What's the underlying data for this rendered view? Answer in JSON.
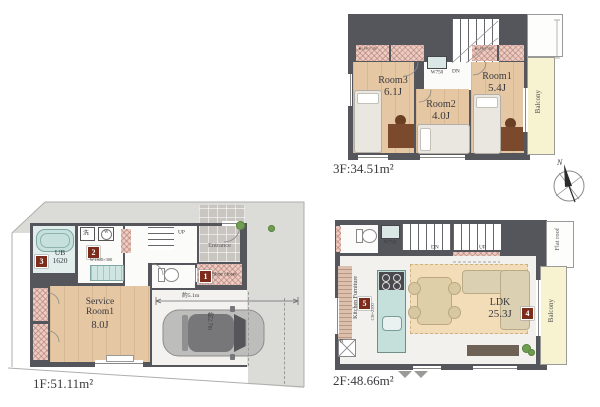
{
  "compass": {
    "label": "N"
  },
  "badges": {
    "b1": "1",
    "b2": "2",
    "b3": "3",
    "b4": "4",
    "b5": "5"
  },
  "floor3": {
    "area_label": "3F:34.51m²",
    "rooms": [
      {
        "name": "Room3",
        "size": "6.1J"
      },
      {
        "name": "Room2",
        "size": "4.0J"
      },
      {
        "name": "Room1",
        "size": "5.4J"
      }
    ],
    "balcony_label": "Balcony",
    "closet_label": "W750",
    "stair_down_label": "DN",
    "closet_note_left": "▲CH=1.3m",
    "closet_note_right": "▲CH=1.3m"
  },
  "floor2": {
    "area_label": "2F:48.66m²",
    "ldk_name": "LDK",
    "ldk_size": "25.3J",
    "balcony_label": "Balcony",
    "flat_roof_label": "Flat roof",
    "kitchen_furniture_label": "Kitchen Furniture",
    "kitchen_dim": "CH=2500",
    "closet_label": "W750",
    "stair_down_label": "DN",
    "stair_up_label": "UP",
    "fridge_label": "R"
  },
  "floor1": {
    "area_label": "1F:51.11m²",
    "service_room_line1": "Service",
    "service_room_line2": "Room1",
    "service_room_size": "8.0J",
    "bath_name": "UB",
    "bath_size": "1620",
    "vanity_dim": "W1300×300",
    "washbasin_icon": "洗",
    "washer_icon": "W",
    "entrance_label": "Entrance",
    "shoe_closet_label": "Shoe closet",
    "stair_up_label": "UP",
    "garage_width": "約5.1m",
    "garage_depth": "約2.7m"
  },
  "colors": {
    "wall": "#55565b",
    "wood_floor": "#e6c7a3",
    "balcony": "#f7f3d0",
    "closet_hatch": "#ecccc2",
    "kitchen_teal": "#c5dfdb",
    "badge": "#7d2c1c"
  }
}
